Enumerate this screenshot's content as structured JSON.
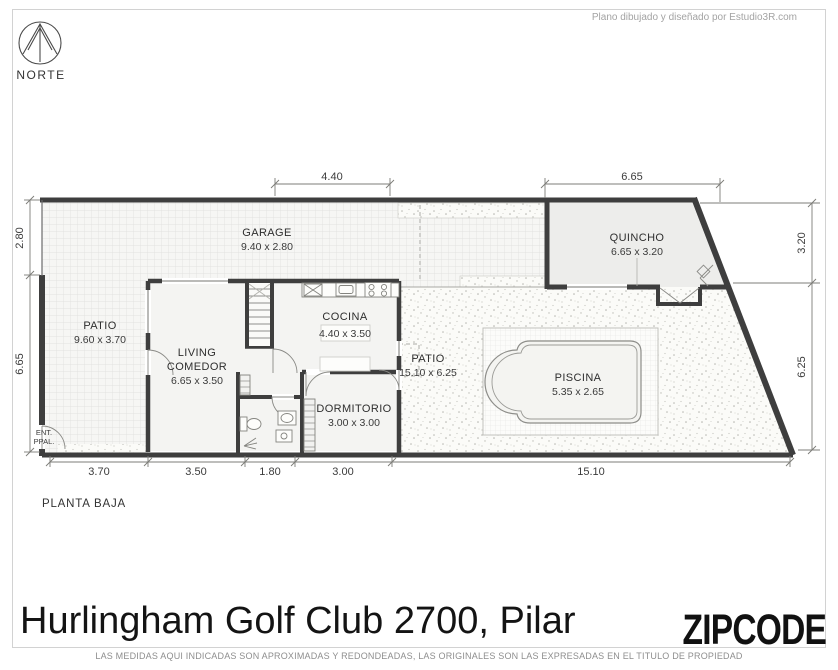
{
  "compass": {
    "label": "NORTE"
  },
  "credit": "Plano dibujado y diseñado por Estudio3R.com",
  "rooms": {
    "garage": {
      "name": "GARAGE",
      "size": "9.40 x 2.80"
    },
    "quincho": {
      "name": "QUINCHO",
      "size": "6.65 x 3.20"
    },
    "patio_left": {
      "name": "PATIO",
      "size": "9.60 x 3.70"
    },
    "living": {
      "name1": "LIVING",
      "name2": "COMEDOR",
      "size": "6.65 x 3.50"
    },
    "cocina": {
      "name": "COCINA",
      "size": "4.40 x 3.50"
    },
    "dormitorio": {
      "name": "DORMITORIO",
      "size": "3.00 x 3.00"
    },
    "patio_right": {
      "name": "PATIO",
      "size": "15.10 x 6.25"
    },
    "piscina": {
      "name": "PISCINA",
      "size": "5.35 x 2.65"
    }
  },
  "entry": {
    "line1": "ENT.",
    "line2": "PPAL."
  },
  "dimensions": {
    "top_garage": "4.40",
    "top_quincho": "6.65",
    "left_upper": "2.80",
    "left_lower": "6.65",
    "right_upper": "3.20",
    "right_lower": "6.25",
    "bottom": [
      "3.70",
      "3.50",
      "1.80",
      "3.00",
      "15.10"
    ]
  },
  "plan": {
    "floor_label": "PLANTA BAJA"
  },
  "footer": {
    "title": "Hurlingham Golf Club 2700, Pilar",
    "brand": "ZIPCODE",
    "disclaimer": "LAS MEDIDAS AQUI INDICADAS SON APROXIMADAS Y REDONDEADAS, LAS ORIGINALES SON LAS EXPRESADAS EN EL TITULO DE PROPIEDAD"
  },
  "colors": {
    "wall": "#3e3e3e",
    "dimension": "#6f6f6f",
    "accentText": "#2e2e2e"
  }
}
